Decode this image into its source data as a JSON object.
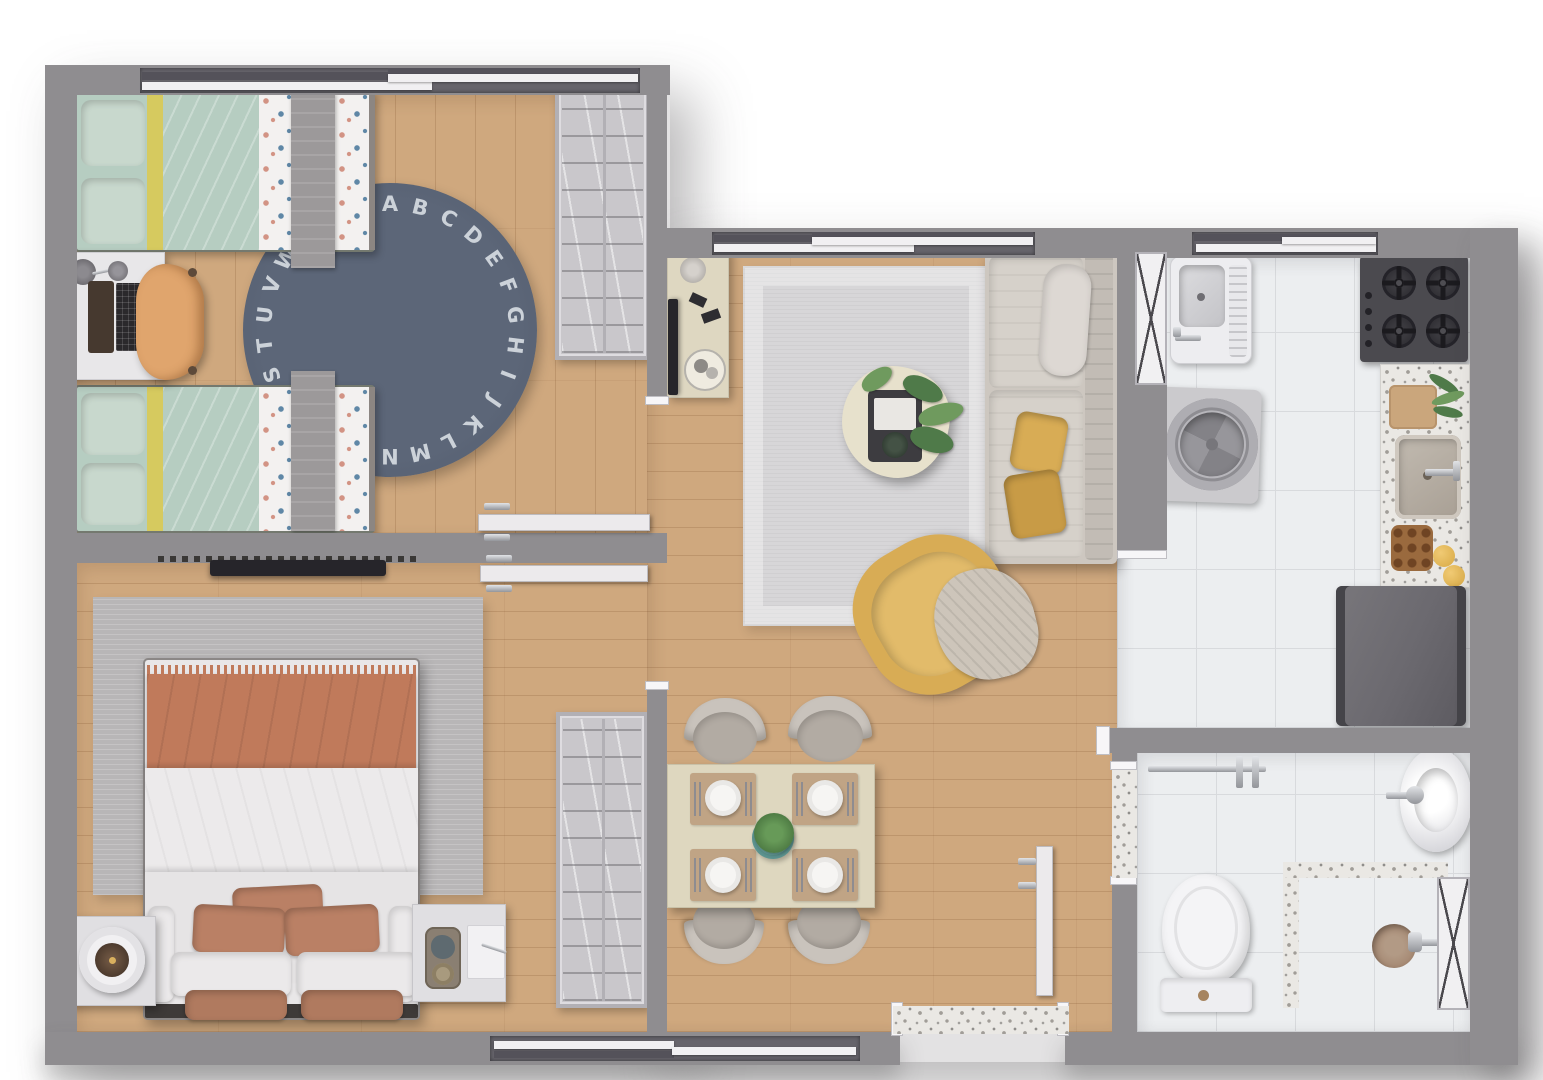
{
  "scene": {
    "type": "apartment-floor-plan-top-view",
    "rooms": {
      "kids_bedroom": {
        "furniture": [
          "twin-bed",
          "twin-bed",
          "study-desk",
          "desk-chair",
          "alphabet-rug",
          "wardrobe"
        ],
        "rug": {
          "letters": "ABCDEFGHIJKLMNOPQRSTUVWXYZ"
        }
      },
      "living_room": {
        "furniture": [
          "sofa",
          "yellow-armchair",
          "coffee-table",
          "tv-sideboard",
          "area-rug"
        ]
      },
      "dining_area": {
        "furniture": [
          "dining-table",
          "dining-chair",
          "dining-chair",
          "dining-chair",
          "dining-chair",
          "closet"
        ]
      },
      "master_bedroom": {
        "furniture": [
          "double-bed",
          "nightstand-left",
          "nightstand-right",
          "table-lamp",
          "wall-tv",
          "area-rug"
        ]
      },
      "kitchen_laundry": {
        "appliances": [
          "laundry-tank",
          "washing-machine",
          "gas-cooktop",
          "counter-with-sink",
          "refrigerator"
        ]
      },
      "bathroom": {
        "fixtures": [
          "toilet",
          "round-washbasin",
          "shower-area",
          "towel-bar"
        ]
      }
    }
  },
  "colors": {
    "wall": "#8f8d90",
    "cap": "#f7f6f8",
    "wood": "#cfa87e",
    "woodline": "rgba(118,72,34,0.20)",
    "woodseam": "rgba(118,72,34,0.08)",
    "tile": "#eceef0",
    "grout": "#d8dadd",
    "terrazzo": "#eae8e4",
    "speck": "#a19d98",
    "mint": "#b6cdc1",
    "mintlight": "#c8d8cd",
    "yellowstripe": "#d6ca5f",
    "patternbase": "#f3f1f0",
    "ppink": "#d29384",
    "pblue": "#5f87a6",
    "graythrow": "#9c999a",
    "navyrug": "#5c6678",
    "rugletter": "#ccd2d9",
    "closet": "#c9c7cb",
    "closetframe": "#b2b0b5",
    "desk": "#e8e7e9",
    "laptop": "#46392f",
    "keys": "#2b292c",
    "chairtan": "#e0a56d",
    "livingrug": "#d7d6d8",
    "sofa": "#cdc7c0",
    "sofaseat": "#d6d1ca",
    "sofaback": "#c2bcb5",
    "bolster": "#ddd8d3",
    "accent": "#d8ac55",
    "accentdark": "#c89b46",
    "sideboard": "#ded7c1",
    "coffeetable": "#e7e1cc",
    "tvblack": "#26252a",
    "tray": "#3d3c40",
    "plant": "#4f7a49",
    "plantlight": "#6f9a5e",
    "potteal": "#6ba5a1",
    "table": "#ded7bf",
    "placemat": "#c0a485",
    "plate": "#f6f5f3",
    "cutlery": "#8e8c90",
    "chairback": "#c9c3bc",
    "chairseat": "#b2aba3",
    "masterrug": "#b8b6b7",
    "duvet": "#e9e7e8",
    "terracotta": "#c07a5b",
    "pillowterra": "#ba8065",
    "pillowwhite": "#ebe9ea",
    "bedframe": "#3e3a38",
    "nightstand": "#e0dfe2",
    "fixture": "#f4f4f6",
    "chrome": "#c6c8cc",
    "chromedark": "#8a8c91",
    "drain": "#a2846e",
    "cooktop": "#4b4a4f",
    "burner": "#2e2d32",
    "grate": "#1b1a1e",
    "fridge": "#6b696f",
    "fridgeedge": "#454449",
    "washer": "#cbcacd",
    "drum": "#97969b",
    "drumdark": "#838287",
    "tanque": "#ededf0",
    "door": "#eceaec",
    "doorline": "#bdbbbf",
    "sill": "#f1f0f2",
    "glass": "#66646b"
  }
}
